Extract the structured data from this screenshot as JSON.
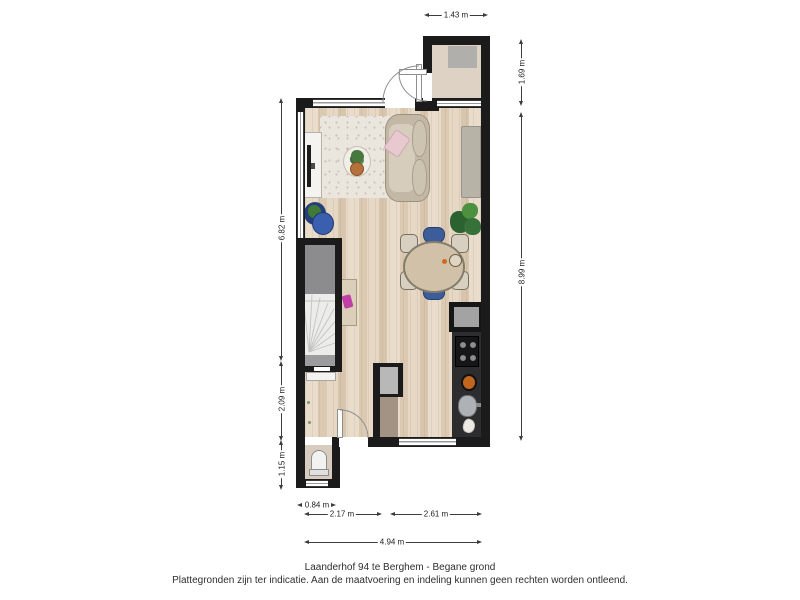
{
  "caption": {
    "line1": "Laanderhof 94 te Berghem - Begane grond",
    "line2": "Plattegronden zijn ter indicatie. Aan de maatvoering en indeling kunnen geen rechten worden ontleend."
  },
  "dimensions": {
    "top_porch_width": "1.43 m",
    "right_porch_height": "1.69 m",
    "right_main_height": "8.99 m",
    "left_living_height": "6.82 m",
    "left_hall_height": "2.09 m",
    "left_toilet_height": "1.15 m",
    "bottom_toilet_width": "0.84 m",
    "bottom_left_width": "2.17 m",
    "bottom_right_width": "2.61 m",
    "bottom_total_width": "4.94 m"
  },
  "colors": {
    "wall": "#1b1b1b",
    "wood_floor": "#e2d2bd",
    "kitchen_counter": "#2d2d30",
    "stairs_light": "#ececea",
    "stairs_dark": "#8c8c8e",
    "chair_blue": "#3c5d99",
    "pillow_pink": "#e7c9cf",
    "accent_magenta": "#c33fa8",
    "plant_green": "#3f7a37",
    "dimension_text": "#222222"
  }
}
